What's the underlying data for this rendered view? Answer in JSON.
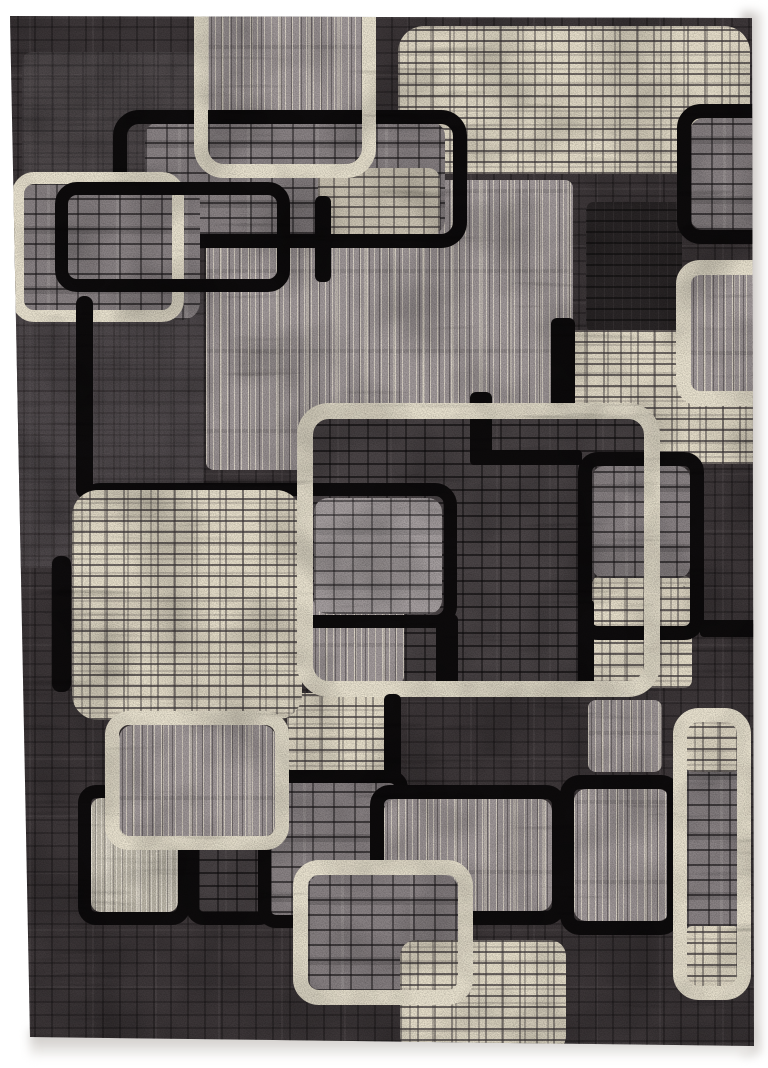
{
  "scene": {
    "description": "Product photo of a modern abstract area rug on a white background. Charcoal mottled ground with interlocking rounded squares: ivory brick-maze squares, gray brick squares, vertically striped gray squares, thick black rounded-square outlines and thick cream rounded-square outlines.",
    "canvas": {
      "width": 768,
      "height": 1068
    },
    "rug": {
      "clip": "polygon(10px 16px,752px 18px,754px 1046px,30px 1037px)",
      "background_texture": "bg"
    },
    "palette": {
      "page_white": "#ffffff",
      "rug_ground": "#3e383a",
      "outline_black": "#0e0c0d",
      "outline_cream": "#ece5d2",
      "ivory": "#e9e1cd",
      "gray_brick": "#8b8486",
      "striped_gray": "#a39b9c",
      "striped_light": "#c6c0b2",
      "dark_brick": "#4b4547"
    },
    "shapes": [
      {
        "name": "bg-patch-top-left",
        "kind": "fill",
        "tex": "bgLight",
        "x": 22,
        "y": 52,
        "w": 180,
        "h": 135,
        "r": 10,
        "opacity": 0.5
      },
      {
        "name": "bg-patch-left-mid",
        "kind": "fill",
        "tex": "bgLight",
        "x": 8,
        "y": 278,
        "w": 196,
        "h": 290,
        "r": 10,
        "opacity": 0.55
      },
      {
        "name": "ivory-square-top-right",
        "kind": "fill",
        "tex": "ivoryBrick",
        "x": 398,
        "y": 26,
        "w": 352,
        "h": 148,
        "r": 26
      },
      {
        "name": "striped-square-top",
        "kind": "fill",
        "tex": "stripes",
        "x": 208,
        "y": -24,
        "w": 154,
        "h": 190,
        "r": 16
      },
      {
        "name": "striped-field-mid",
        "kind": "fill",
        "tex": "stripes",
        "x": 206,
        "y": 180,
        "w": 367,
        "h": 290,
        "r": 8
      },
      {
        "name": "dark-patch-right",
        "kind": "fill",
        "tex": "darkPatch",
        "x": 586,
        "y": 202,
        "w": 96,
        "h": 130,
        "r": 8
      },
      {
        "name": "graybrick-panel-top",
        "kind": "fill",
        "tex": "grayBrick",
        "x": 145,
        "y": 122,
        "w": 300,
        "h": 112,
        "r": 14
      },
      {
        "name": "lightbrick-patch-top",
        "kind": "fill",
        "tex": "ivoryDim",
        "x": 318,
        "y": 168,
        "w": 122,
        "h": 70,
        "r": 12
      },
      {
        "name": "black-outline-top",
        "kind": "outline",
        "tex": "black",
        "x": 113,
        "y": 110,
        "w": 354,
        "h": 138,
        "r": 26,
        "stroke": 14
      },
      {
        "name": "cream-outline-top",
        "kind": "outline",
        "tex": "cream",
        "x": 194,
        "y": -36,
        "w": 182,
        "h": 214,
        "r": 30,
        "stroke": 14
      },
      {
        "name": "graybrick-square-top-left",
        "kind": "fill",
        "tex": "grayBrick",
        "x": 14,
        "y": 184,
        "w": 186,
        "h": 136,
        "r": 18
      },
      {
        "name": "cream-outline-top-left",
        "kind": "outline",
        "tex": "cream",
        "x": 12,
        "y": 172,
        "w": 172,
        "h": 150,
        "r": 22,
        "stroke": 12
      },
      {
        "name": "black-outline-top-left",
        "kind": "outline",
        "tex": "black",
        "x": 55,
        "y": 182,
        "w": 235,
        "h": 110,
        "r": 22,
        "stroke": 13
      },
      {
        "name": "black-bar-a",
        "kind": "fill",
        "tex": "black",
        "x": 315,
        "y": 196,
        "w": 16,
        "h": 86,
        "r": 6
      },
      {
        "name": "graybrick-fill-top-right-corner",
        "kind": "fill",
        "tex": "grayBrick",
        "x": 690,
        "y": 118,
        "w": 100,
        "h": 112,
        "r": 14
      },
      {
        "name": "black-outline-top-right",
        "kind": "outline",
        "tex": "black",
        "x": 677,
        "y": 104,
        "w": 130,
        "h": 140,
        "r": 24,
        "stroke": 14
      },
      {
        "name": "black-bar-left-upper",
        "kind": "fill",
        "tex": "black",
        "x": 76,
        "y": 296,
        "w": 17,
        "h": 202,
        "r": 8
      },
      {
        "name": "black-bar-left-lower",
        "kind": "fill",
        "tex": "black",
        "x": 52,
        "y": 556,
        "w": 19,
        "h": 136,
        "r": 8
      },
      {
        "name": "ivory-field-right",
        "kind": "fill",
        "tex": "ivoryBrick",
        "x": 552,
        "y": 330,
        "w": 216,
        "h": 134,
        "r": 14
      },
      {
        "name": "center-square-fill",
        "kind": "fill",
        "tex": "darkBrick",
        "x": 310,
        "y": 418,
        "w": 338,
        "h": 268,
        "r": 14
      },
      {
        "name": "center-stripe-patch",
        "kind": "fill",
        "tex": "stripes",
        "x": 312,
        "y": 598,
        "w": 92,
        "h": 86,
        "r": 8
      },
      {
        "name": "center-inner-brick-fill",
        "kind": "fill",
        "tex": "grayBrickLight",
        "x": 314,
        "y": 498,
        "w": 128,
        "h": 116,
        "r": 14
      },
      {
        "name": "center-inner-black-outline",
        "kind": "outline",
        "tex": "black",
        "x": 78,
        "y": 483,
        "w": 379,
        "h": 145,
        "r": 22,
        "stroke": 13
      },
      {
        "name": "black-bar-center-a",
        "kind": "fill",
        "tex": "black",
        "x": 551,
        "y": 318,
        "w": 24,
        "h": 96,
        "r": 6
      },
      {
        "name": "black-bar-center-b",
        "kind": "fill",
        "tex": "black",
        "x": 470,
        "y": 392,
        "w": 22,
        "h": 72,
        "r": 6
      },
      {
        "name": "black-bar-center-c",
        "kind": "fill",
        "tex": "black",
        "x": 470,
        "y": 450,
        "w": 112,
        "h": 15,
        "r": 4
      },
      {
        "name": "black-bar-center-d",
        "kind": "fill",
        "tex": "black",
        "x": 436,
        "y": 614,
        "w": 22,
        "h": 76,
        "r": 6
      },
      {
        "name": "ivory-patch-mid-right",
        "kind": "fill",
        "tex": "ivoryBrick",
        "x": 592,
        "y": 576,
        "w": 100,
        "h": 112,
        "r": 8
      },
      {
        "name": "black-bar-mid-right-left-edge",
        "kind": "fill",
        "tex": "black",
        "x": 578,
        "y": 600,
        "w": 16,
        "h": 90,
        "r": 4
      },
      {
        "name": "graybrick-fill-mid-right",
        "kind": "fill",
        "tex": "grayBrick",
        "x": 592,
        "y": 466,
        "w": 98,
        "h": 112,
        "r": 12
      },
      {
        "name": "black-outline-mid-right",
        "kind": "outline",
        "tex": "black",
        "x": 578,
        "y": 452,
        "w": 126,
        "h": 188,
        "r": 20,
        "stroke": 14
      },
      {
        "name": "black-bar-mid-right-ext",
        "kind": "fill",
        "tex": "black",
        "x": 700,
        "y": 620,
        "w": 68,
        "h": 17,
        "r": 4
      },
      {
        "name": "striped-fill-right-edge",
        "kind": "fill",
        "tex": "stripes",
        "x": 690,
        "y": 274,
        "w": 92,
        "h": 118,
        "r": 12
      },
      {
        "name": "cream-outline-right-edge",
        "kind": "outline",
        "tex": "cream",
        "x": 676,
        "y": 260,
        "w": 122,
        "h": 146,
        "r": 24,
        "stroke": 15
      },
      {
        "name": "ivory-patch-center-left",
        "kind": "fill",
        "tex": "ivoryBrick",
        "x": 287,
        "y": 693,
        "w": 106,
        "h": 80,
        "r": 10
      },
      {
        "name": "ivory-square-big-left",
        "kind": "fill",
        "tex": "ivoryBrick",
        "x": 72,
        "y": 490,
        "w": 230,
        "h": 230,
        "r": 26
      },
      {
        "name": "cream-outline-center-big",
        "kind": "outline",
        "tex": "cream",
        "x": 297,
        "y": 403,
        "w": 363,
        "h": 294,
        "r": 32,
        "stroke": 16
      },
      {
        "name": "striped-patch-below-center",
        "kind": "fill",
        "tex": "stripes",
        "x": 588,
        "y": 700,
        "w": 74,
        "h": 72,
        "r": 8
      },
      {
        "name": "black-bar-bottom-a",
        "kind": "fill",
        "tex": "black",
        "x": 384,
        "y": 694,
        "w": 17,
        "h": 100,
        "r": 6
      },
      {
        "name": "black-outline-bottom-left-1",
        "kind": "outline",
        "tex": "black",
        "x": 78,
        "y": 785,
        "w": 112,
        "h": 140,
        "r": 18,
        "stroke": 13
      },
      {
        "name": "striped-light-fill",
        "kind": "fill",
        "tex": "stripesLight",
        "x": 91,
        "y": 798,
        "w": 87,
        "h": 114,
        "r": 10
      },
      {
        "name": "bl2-dark-fill",
        "kind": "fill",
        "tex": "darkBrick",
        "x": 198,
        "y": 797,
        "w": 66,
        "h": 116,
        "r": 10
      },
      {
        "name": "black-outline-bottom-left-2",
        "kind": "outline",
        "tex": "black",
        "x": 186,
        "y": 785,
        "w": 90,
        "h": 140,
        "r": 18,
        "stroke": 13
      },
      {
        "name": "graybrick-fill-bottom-mid",
        "kind": "fill",
        "tex": "grayBrick",
        "x": 270,
        "y": 782,
        "w": 138,
        "h": 146,
        "r": 14
      },
      {
        "name": "black-outline-bottom-mid",
        "kind": "outline",
        "tex": "black",
        "x": 258,
        "y": 770,
        "w": 150,
        "h": 158,
        "r": 18,
        "stroke": 13
      },
      {
        "name": "striped-fill-c3",
        "kind": "fill",
        "tex": "stripes",
        "x": 119,
        "y": 725,
        "w": 157,
        "h": 112,
        "r": 14
      },
      {
        "name": "cream-outline-bottom-left",
        "kind": "outline",
        "tex": "cream",
        "x": 105,
        "y": 711,
        "w": 184,
        "h": 139,
        "r": 24,
        "stroke": 14
      },
      {
        "name": "striped-fill-b4",
        "kind": "fill",
        "tex": "stripes",
        "x": 384,
        "y": 799,
        "w": 168,
        "h": 112,
        "r": 12
      },
      {
        "name": "black-outline-bottom-center",
        "kind": "outline",
        "tex": "black",
        "x": 370,
        "y": 785,
        "w": 196,
        "h": 140,
        "r": 20,
        "stroke": 14
      },
      {
        "name": "striped-fill-b5",
        "kind": "fill",
        "tex": "stripes",
        "x": 574,
        "y": 789,
        "w": 96,
        "h": 132,
        "r": 12
      },
      {
        "name": "black-outline-bottom-right",
        "kind": "outline",
        "tex": "black",
        "x": 560,
        "y": 775,
        "w": 121,
        "h": 160,
        "r": 20,
        "stroke": 14
      },
      {
        "name": "graybrick-fill-c4",
        "kind": "fill",
        "tex": "grayBrick",
        "x": 308,
        "y": 875,
        "w": 150,
        "h": 116,
        "r": 14
      },
      {
        "name": "ivory-square-bottom",
        "kind": "fill",
        "tex": "ivoryBrick",
        "x": 400,
        "y": 940,
        "w": 166,
        "h": 112,
        "r": 16
      },
      {
        "name": "cream-outline-bottom-center",
        "kind": "outline",
        "tex": "cream",
        "x": 293,
        "y": 860,
        "w": 180,
        "h": 145,
        "r": 26,
        "stroke": 15
      },
      {
        "name": "c6-graybrick-fill",
        "kind": "fill",
        "tex": "grayBrick",
        "x": 687,
        "y": 722,
        "w": 52,
        "h": 264,
        "r": 10
      },
      {
        "name": "c6-ivory-top",
        "kind": "fill",
        "tex": "ivoryBrick",
        "x": 685,
        "y": 714,
        "w": 56,
        "h": 58,
        "r": 8
      },
      {
        "name": "c6-ivory-bottom",
        "kind": "fill",
        "tex": "ivoryBrick",
        "x": 685,
        "y": 926,
        "w": 56,
        "h": 62,
        "r": 8
      },
      {
        "name": "cream-outline-right-column",
        "kind": "outline",
        "tex": "cream",
        "x": 673,
        "y": 708,
        "w": 78,
        "h": 292,
        "r": 26,
        "stroke": 14
      }
    ]
  }
}
